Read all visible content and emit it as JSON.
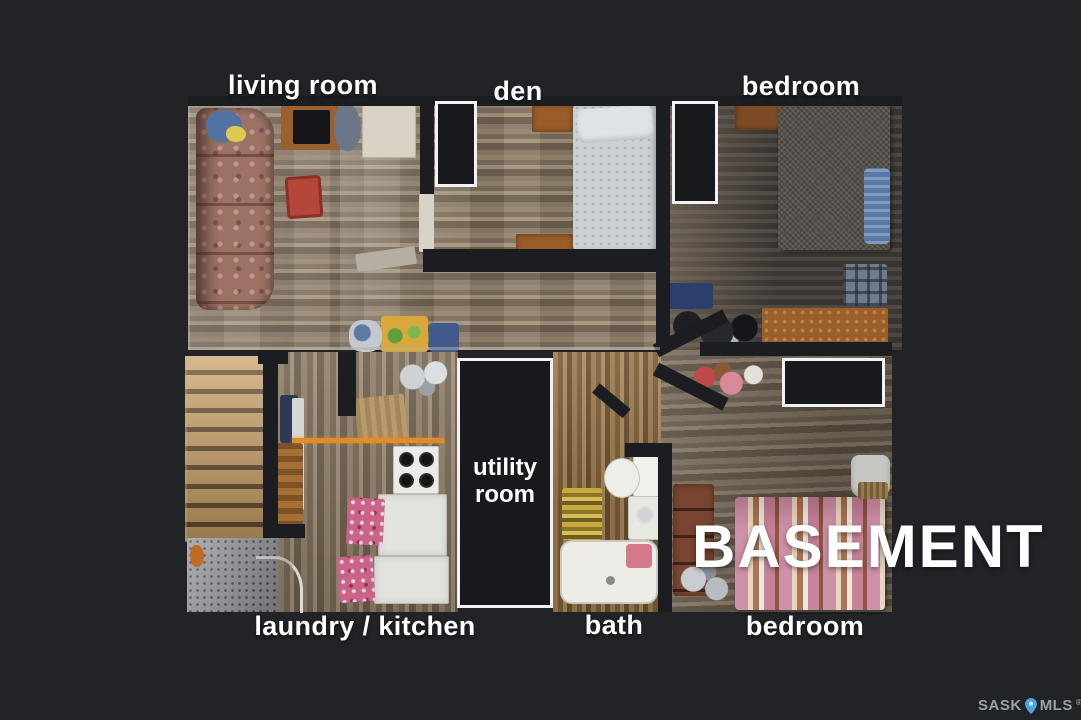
{
  "rooms": {
    "living_room": {
      "label": "living room"
    },
    "den": {
      "label": "den"
    },
    "bedroom_top": {
      "label": "bedroom"
    },
    "laundry_kitchen": {
      "label": "laundry / kitchen"
    },
    "bath": {
      "label": "bath"
    },
    "bedroom_bottom": {
      "label": "bedroom"
    },
    "utility_room": {
      "label": "utility room"
    }
  },
  "title": {
    "text": "BASEMENT"
  },
  "branding": {
    "prefix": "SASK",
    "suffix": "MLS",
    "registered": "®"
  },
  "colors": {
    "background": "#212327",
    "label_text": "#ffffff",
    "wall": "#1b1d21",
    "marker_border": "#f2f2f2",
    "brand_text": "#9aa1a9",
    "brand_pin": "#4da3dc"
  },
  "icons": {
    "brand_pin": "map-pin-icon"
  }
}
